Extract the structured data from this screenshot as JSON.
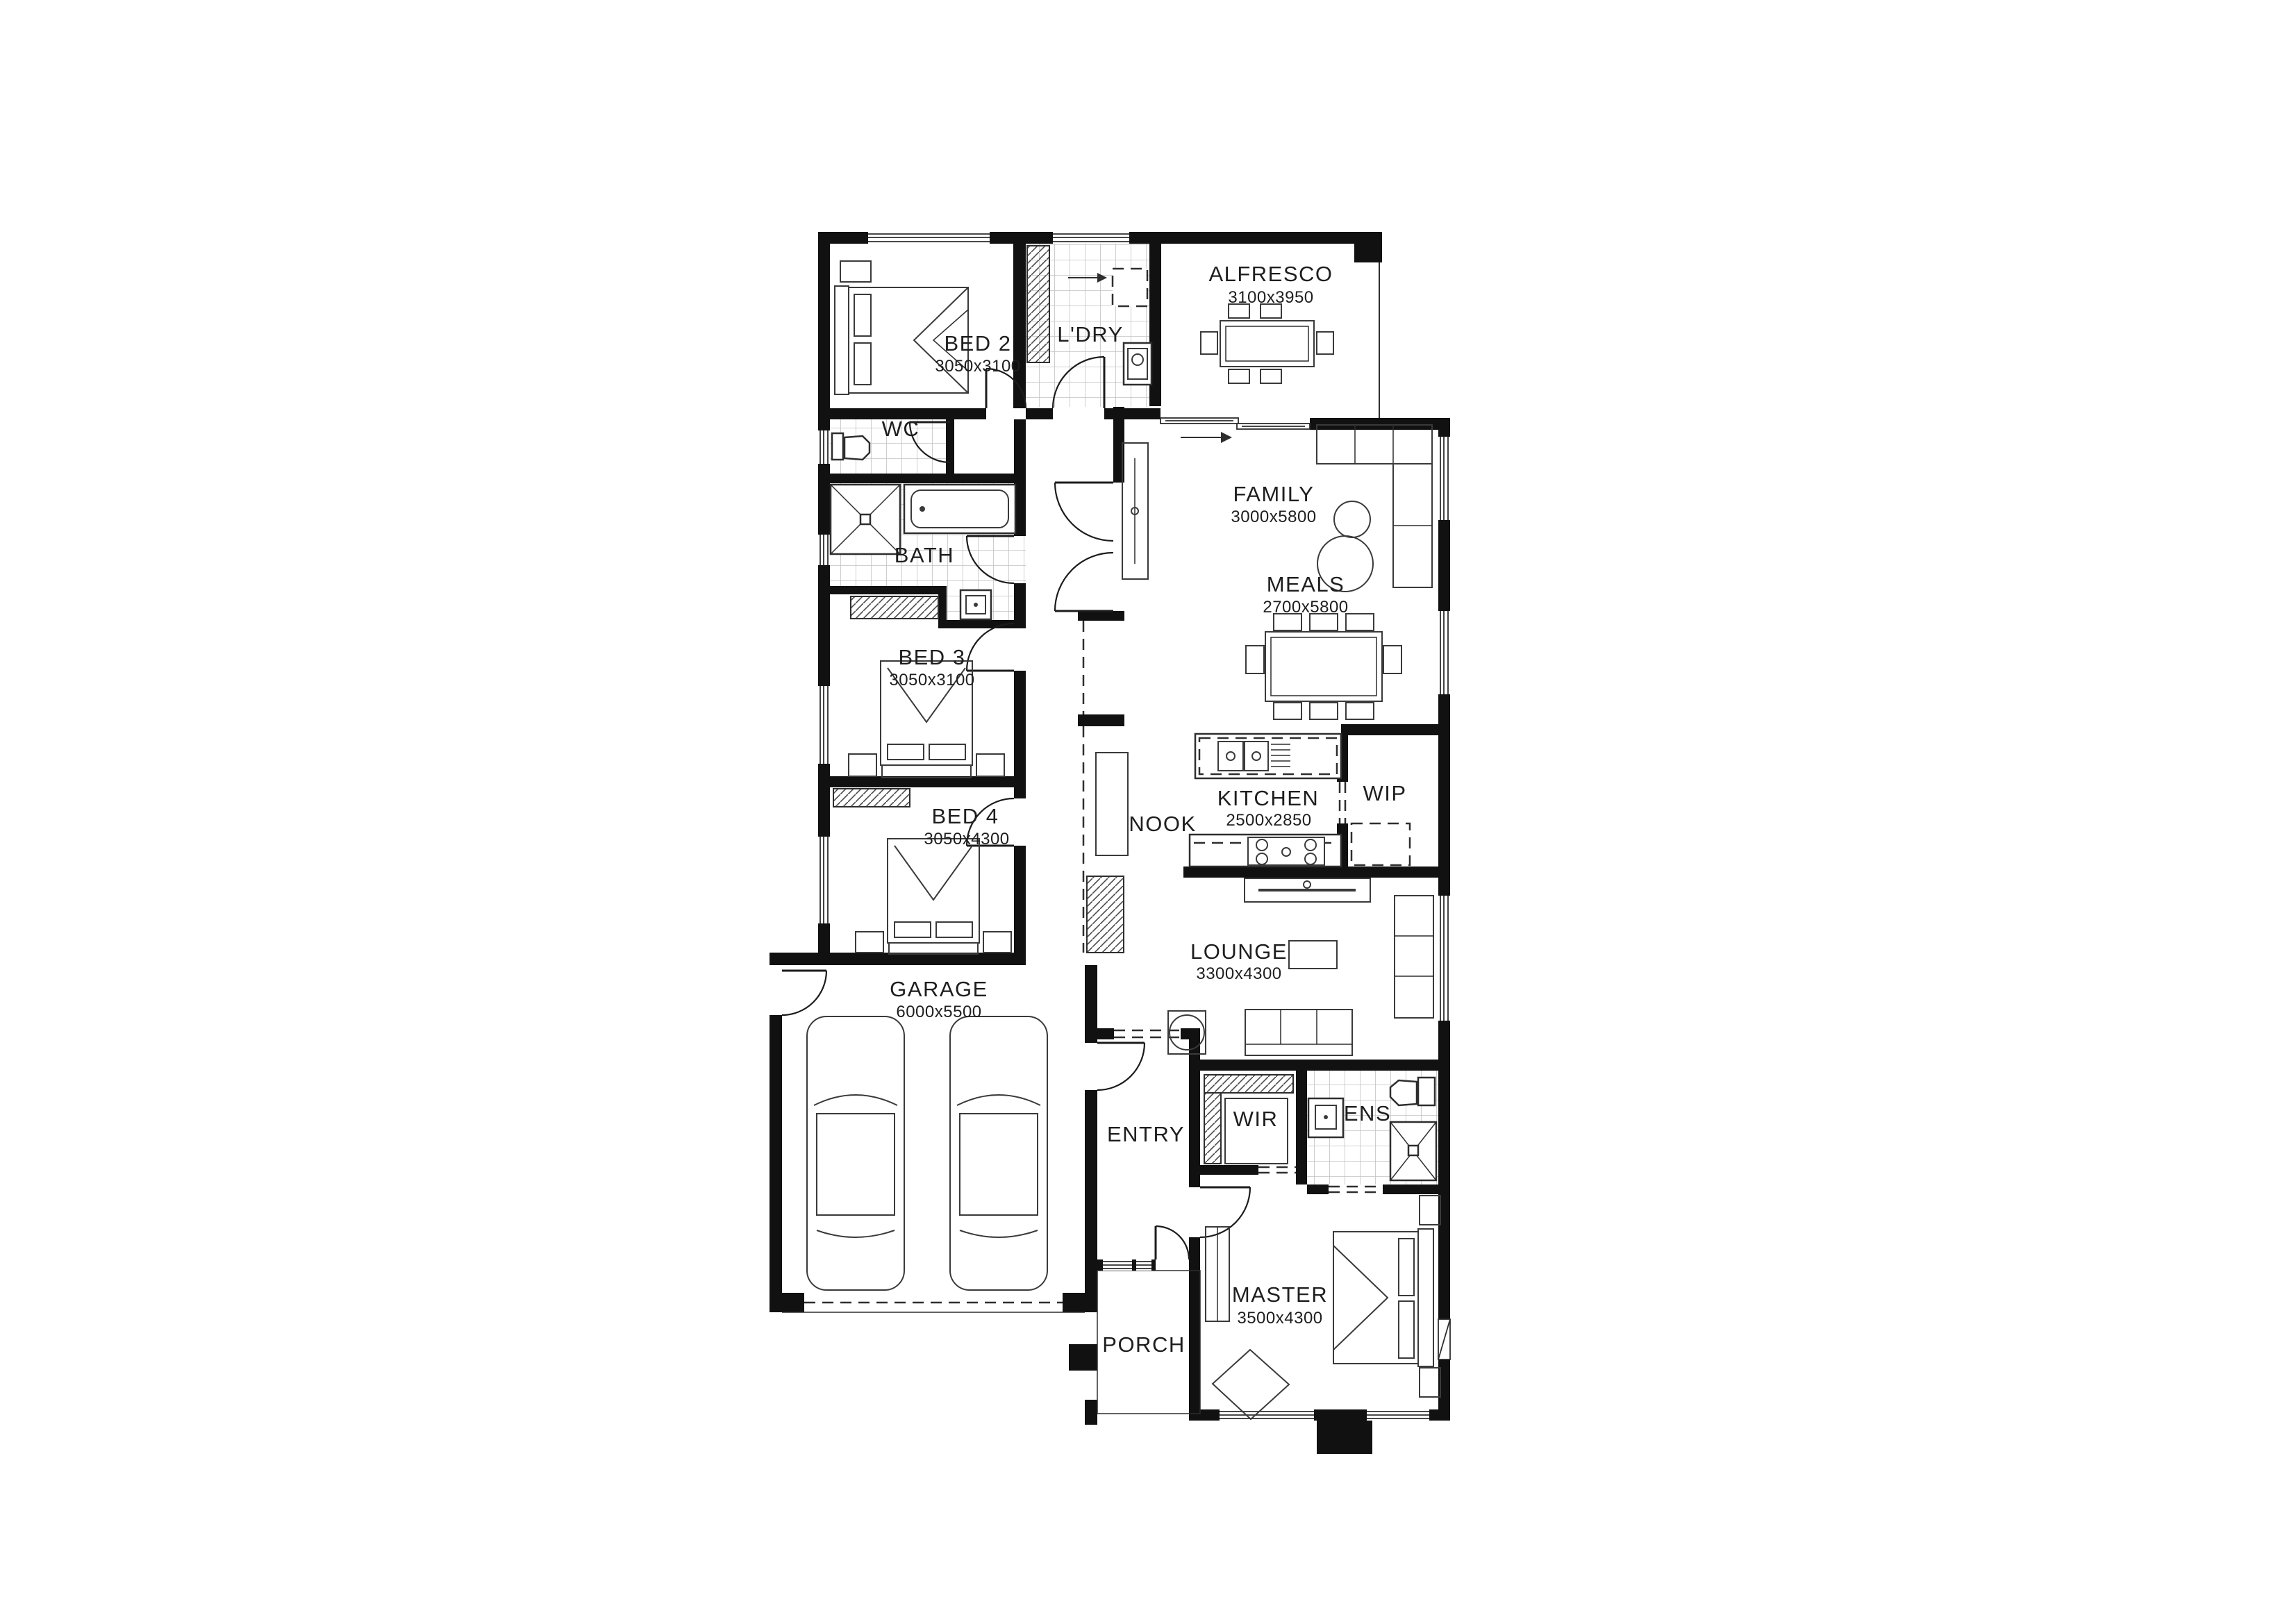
{
  "plan": {
    "type": "residential-floor-plan",
    "style": "black-and-white architectural drawing",
    "colors": {
      "background": "#ffffff",
      "wall": "#111111",
      "line": "#2e2e2e",
      "tile_grid": "#c2c2c2",
      "text": "#1e1e1e"
    }
  },
  "rooms": {
    "bed2": {
      "label": "BED 2",
      "dims": "3050x3100"
    },
    "ldry": {
      "label": "L'DRY",
      "dims": ""
    },
    "alfresco": {
      "label": "ALFRESCO",
      "dims": "3100x3950"
    },
    "wc": {
      "label": "WC",
      "dims": ""
    },
    "family": {
      "label": "FAMILY",
      "dims": "3000x5800"
    },
    "bath": {
      "label": "BATH",
      "dims": ""
    },
    "meals": {
      "label": "MEALS",
      "dims": "2700x5800"
    },
    "bed3": {
      "label": "BED 3",
      "dims": "3050x3100"
    },
    "bed4": {
      "label": "BED 4",
      "dims": "3050x4300"
    },
    "nook": {
      "label": "NOOK",
      "dims": ""
    },
    "kitchen": {
      "label": "KITCHEN",
      "dims": "2500x2850"
    },
    "wip": {
      "label": "WIP",
      "dims": ""
    },
    "lounge": {
      "label": "LOUNGE",
      "dims": "3300x4300"
    },
    "garage": {
      "label": "GARAGE",
      "dims": "6000x5500"
    },
    "entry": {
      "label": "ENTRY",
      "dims": ""
    },
    "wir": {
      "label": "WIR",
      "dims": ""
    },
    "ens": {
      "label": "ENS",
      "dims": ""
    },
    "master": {
      "label": "MASTER",
      "dims": "3500x4300"
    },
    "porch": {
      "label": "PORCH",
      "dims": ""
    }
  }
}
